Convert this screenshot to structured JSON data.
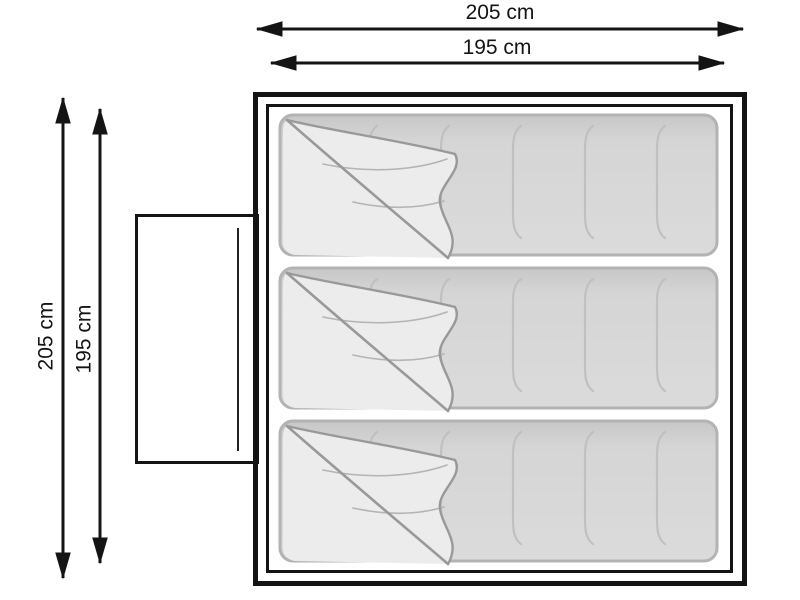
{
  "diagram": {
    "dimensions": {
      "top_outer": "205 cm",
      "top_inner": "195 cm",
      "left_outer": "205 cm",
      "left_inner": "195 cm"
    },
    "tent": {
      "sleeping_bag_count": 3,
      "door_position": "left"
    },
    "colors": {
      "outline": "#141414",
      "bag_fill": "#d6d6d6",
      "bag_border": "#b3b3b3",
      "flap_fill": "#ececec",
      "fold_line": "#999999",
      "seam_line": "#c0c0c0",
      "background": "#ffffff"
    }
  }
}
